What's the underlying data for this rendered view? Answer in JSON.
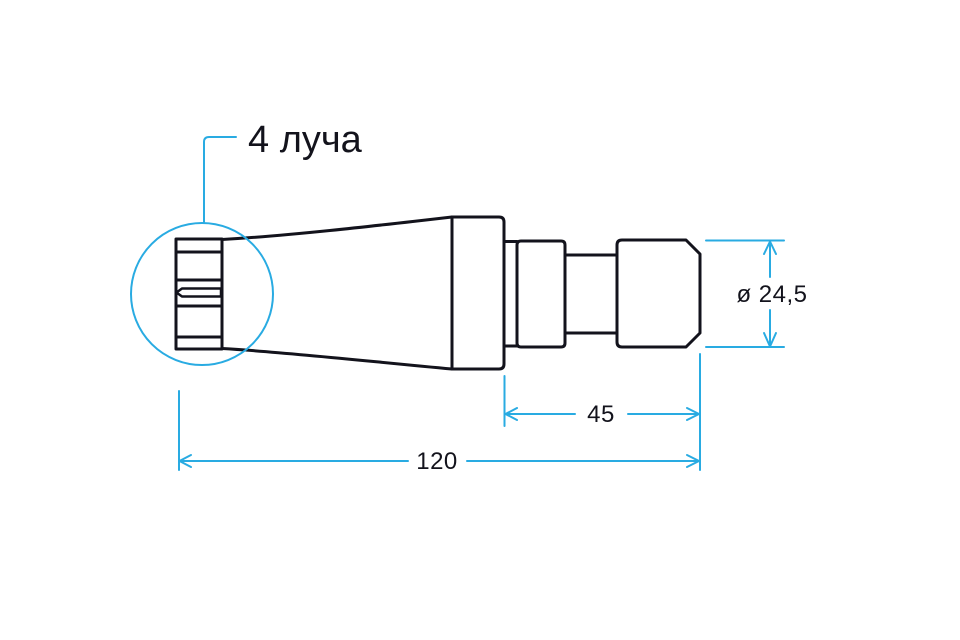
{
  "drawing": {
    "callout_label": "4 луча",
    "dimensions": {
      "diameter": "ø 24,5",
      "shank_length": "45",
      "total_length": "120"
    },
    "colors": {
      "annotation": "#29abe2",
      "ink": "#13131c",
      "background": "#ffffff"
    }
  }
}
